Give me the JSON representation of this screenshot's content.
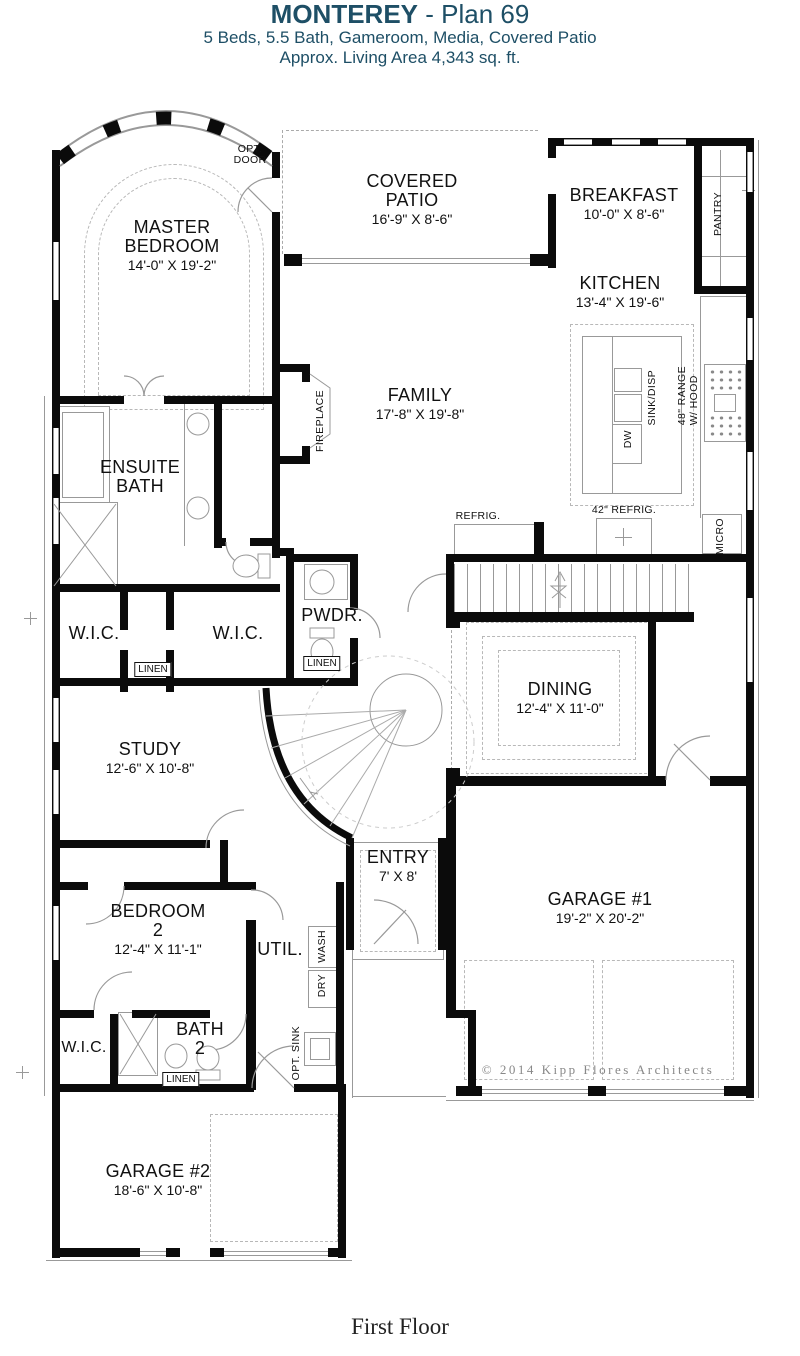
{
  "header": {
    "title_main": "MONTEREY",
    "title_suffix": " - Plan 69",
    "subtitle1": "5 Beds, 5.5 Bath, Gameroom, Media, Covered Patio",
    "subtitle2": "Approx. Living Area 4,343 sq. ft.",
    "color": "#1e4f66"
  },
  "footer": {
    "floor_label": "First Floor",
    "copyright": "© 2014  Kipp  Flores  Architects"
  },
  "rooms": {
    "master": {
      "l1": "MASTER",
      "l2": "BEDROOM",
      "dims": "14'-0\" X 19'-2\""
    },
    "patio": {
      "l1": "COVERED",
      "l2": "PATIO",
      "dims": "16'-9\" X 8'-6\""
    },
    "breakfast": {
      "l1": "BREAKFAST",
      "dims": "10'-0\" X 8'-6\""
    },
    "kitchen": {
      "l1": "KITCHEN",
      "dims": "13'-4\" X 19'-6\""
    },
    "family": {
      "l1": "FAMILY",
      "dims": "17'-8\" X 19'-8\""
    },
    "ensuite": {
      "l1": "ENSUITE",
      "l2": "BATH"
    },
    "wic_left": {
      "l1": "W.I.C."
    },
    "wic_right": {
      "l1": "W.I.C."
    },
    "pwdr": {
      "l1": "PWDR."
    },
    "dining": {
      "l1": "DINING",
      "dims": "12'-4\" X 11'-0\""
    },
    "study": {
      "l1": "STUDY",
      "dims": "12'-6\" X 10'-8\""
    },
    "entry": {
      "l1": "ENTRY",
      "dims": "7' X 8'"
    },
    "garage1": {
      "l1": "GARAGE #1",
      "dims": "19'-2\" X 20'-2\""
    },
    "bedroom2": {
      "l1": "BEDROOM",
      "l2": "2",
      "dims": "12'-4\" X 11'-1\""
    },
    "util": {
      "l1": "UTIL."
    },
    "wic_bed2": {
      "l1": "W.I.C."
    },
    "bath2": {
      "l1": "BATH",
      "l2": "2"
    },
    "garage2": {
      "l1": "GARAGE #2",
      "dims": "18'-6\" X 10'-8\""
    }
  },
  "labels": {
    "opt_door1": "OPT.",
    "opt_door2": "DOOR",
    "fireplace": "FIREPLACE",
    "pantry": "PANTRY",
    "range1": "48\" RANGE",
    "range2": "W/ HOOD",
    "sink_disp": "SINK/DISP",
    "dw": "DW",
    "micro": "MICRO",
    "refrig": "REFRIG.",
    "refrig42": "42\" REFRIG.",
    "wash": "WASH",
    "dry": "DRY",
    "opt_sink": "OPT. SINK",
    "linen": "LINEN"
  },
  "colors": {
    "wall": "#0b0b0b",
    "line": "#999999",
    "dash": "#b8b8b8",
    "title": "#1e4f66",
    "text": "#111111"
  }
}
